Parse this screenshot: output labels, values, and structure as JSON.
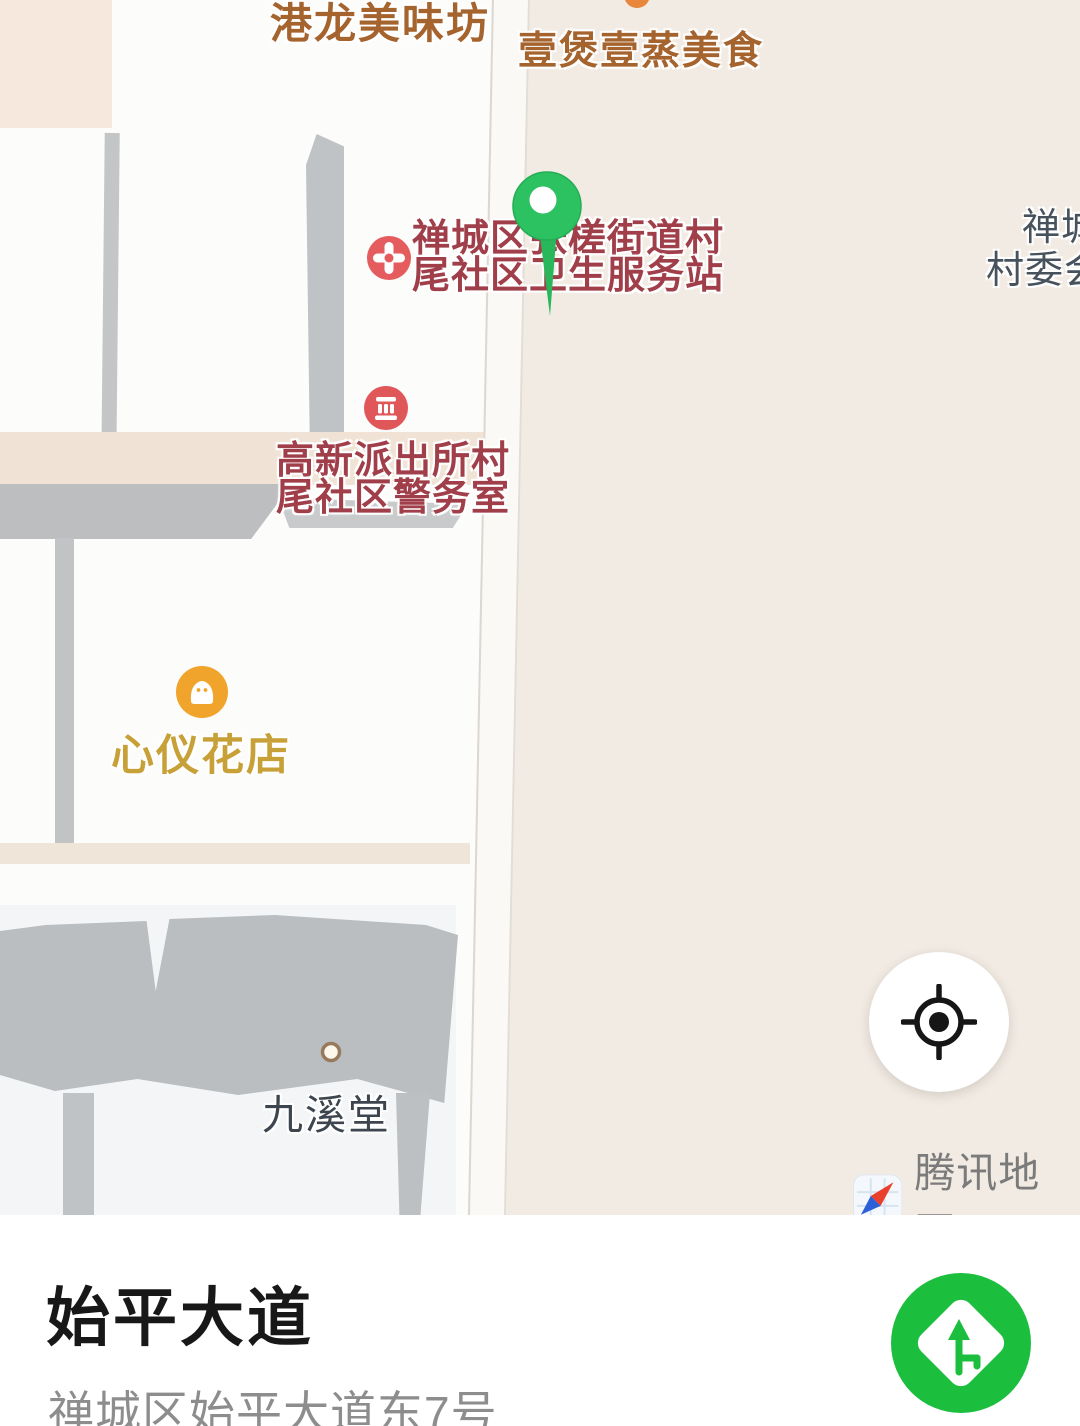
{
  "colors": {
    "map_background": "#f2ebe3",
    "building_white": "#fcfcfa",
    "building_shadow_gray": "#bfc2c4",
    "poi_red_text": "#a03e4a",
    "poi_brown_text": "#a5632e",
    "poi_gold_text": "#c7a037",
    "poi_dark_text": "#3d464e",
    "poi_slate_text": "#47525c",
    "hospital_marker_red": "#e55c5e",
    "police_marker_red": "#e0575a",
    "shop_marker_amber": "#f1a42c",
    "pin_green": "#2cc161",
    "route_button_green": "#1cbe3e",
    "watermark_text_gray": "#7b7b7b"
  },
  "map": {
    "labels": {
      "restaurant_top": "港龙美味坊",
      "restaurant_right": "壹煲壹蒸美食",
      "health_station": {
        "line1": "禅城区张槎街道村",
        "line2": "尾社区卫生服务站"
      },
      "police_room": {
        "line1": "高新派出所村",
        "line2": "尾社区警务室"
      },
      "flower_shop": "心仪花店",
      "hall": "九溪堂",
      "village_committee": {
        "line1": "禅城",
        "line2": "村委会"
      }
    },
    "watermark": {
      "label": "腾讯地图"
    }
  },
  "panel": {
    "title": "始平大道",
    "address": "禅城区始平大道东7号"
  }
}
